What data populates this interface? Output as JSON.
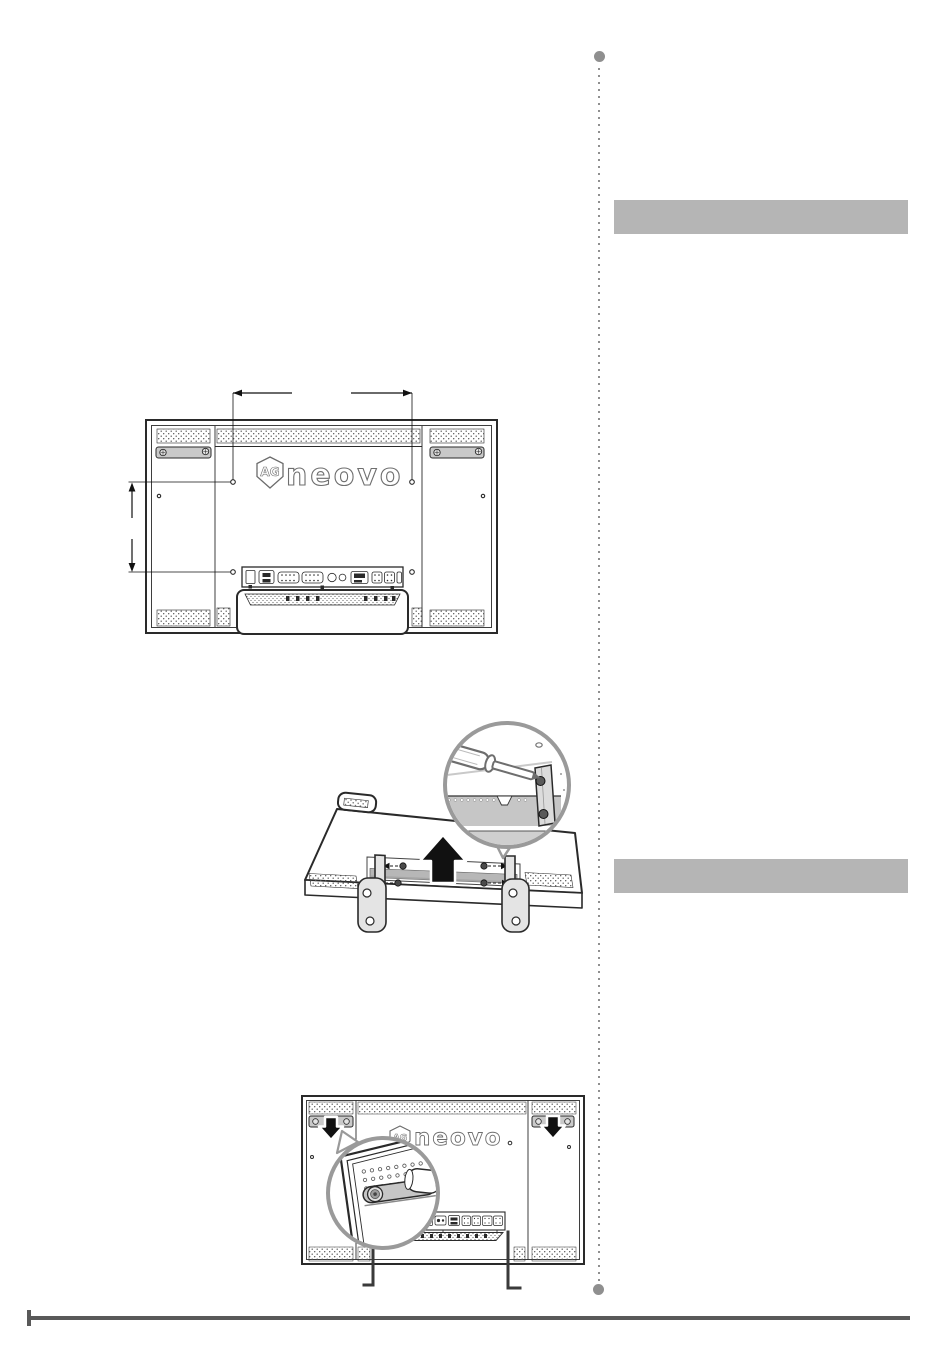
{
  "page": {
    "kind": "monitor-user-manual-page",
    "background": "#ffffff"
  },
  "brand": {
    "logo_badge": "AG",
    "logo_name": "neovo"
  },
  "right_column": {
    "heading_bars": [
      {
        "text": ""
      },
      {
        "text": ""
      }
    ],
    "separator": {
      "style": "vertical-dotted",
      "color": "#8f8f8f"
    }
  },
  "footer": {
    "rule_color": "#595959"
  },
  "colors": {
    "line_art": "#2a2a2a",
    "heading_bar": "#b5b5b5",
    "magnifier_ring": "#9a9a9a",
    "arrow_black": "#111111",
    "handle_gray": "#c9c9c9",
    "stand_bar_gray": "#b7b7b7"
  }
}
